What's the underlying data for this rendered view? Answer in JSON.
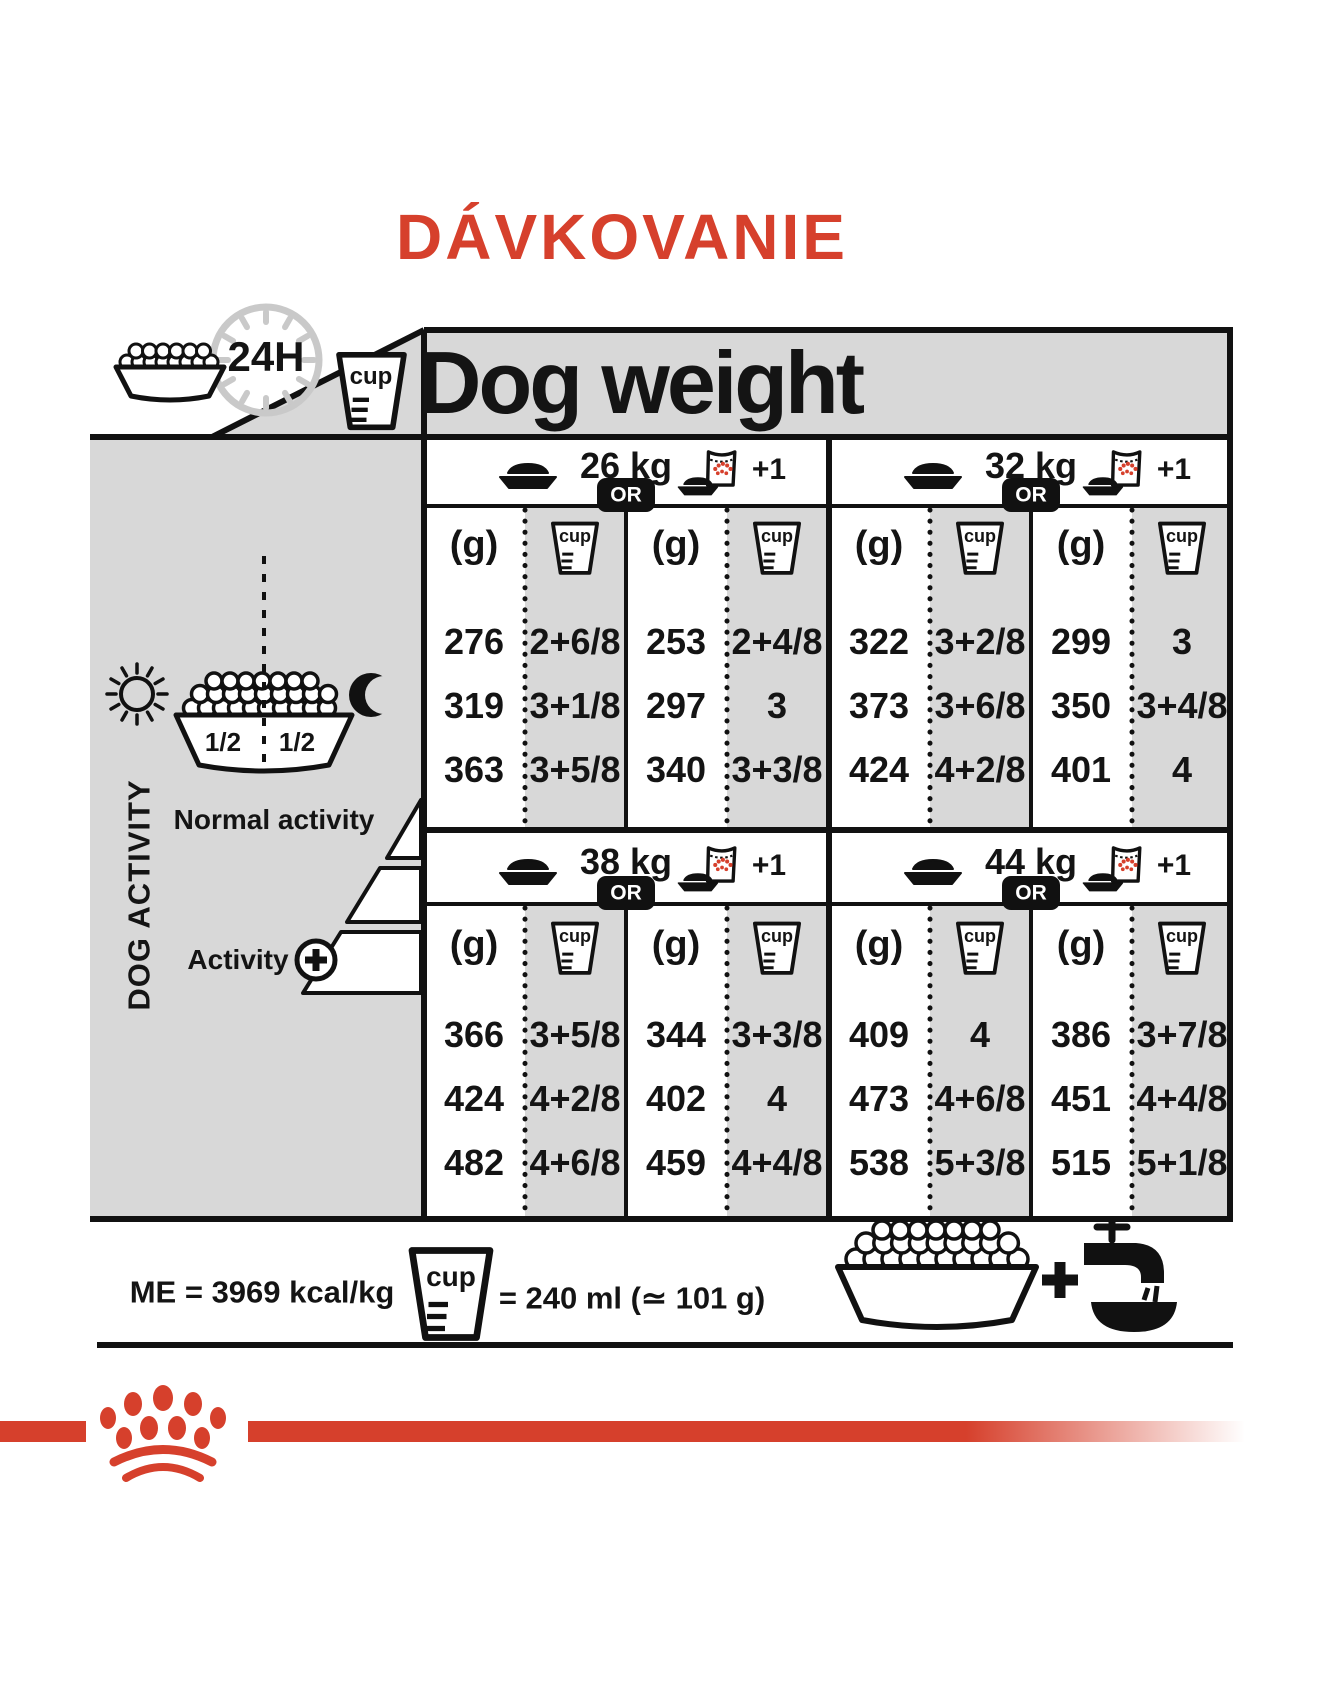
{
  "title": "DÁVKOVANIE",
  "colors": {
    "red": "#d6402c",
    "panel_gray": "#d8d8d8"
  },
  "header": {
    "daily_ration": "24H",
    "dog_weight": "Dog weight"
  },
  "units": {
    "grams": "(g)",
    "cup": "cup",
    "or": "OR",
    "plus_one": "+1"
  },
  "sidebar": {
    "dog_activity": "DOG ACTIVITY",
    "half_left": "1/2",
    "half_right": "1/2",
    "normal_activity": "Normal activity",
    "activity_plus": "Activity"
  },
  "sections": [
    {
      "weight": "26 kg",
      "rows": [
        [
          "276",
          "2+6/8",
          "253",
          "2+4/8"
        ],
        [
          "319",
          "3+1/8",
          "297",
          "3"
        ],
        [
          "363",
          "3+5/8",
          "340",
          "3+3/8"
        ]
      ]
    },
    {
      "weight": "32 kg",
      "rows": [
        [
          "322",
          "3+2/8",
          "299",
          "3"
        ],
        [
          "373",
          "3+6/8",
          "350",
          "3+4/8"
        ],
        [
          "424",
          "4+2/8",
          "401",
          "4"
        ]
      ]
    },
    {
      "weight": "38 kg",
      "rows": [
        [
          "366",
          "3+5/8",
          "344",
          "3+3/8"
        ],
        [
          "424",
          "4+2/8",
          "402",
          "4"
        ],
        [
          "482",
          "4+6/8",
          "459",
          "4+4/8"
        ]
      ]
    },
    {
      "weight": "44 kg",
      "rows": [
        [
          "409",
          "4",
          "386",
          "3+7/8"
        ],
        [
          "473",
          "4+6/8",
          "451",
          "4+4/8"
        ],
        [
          "538",
          "5+3/8",
          "515",
          "5+1/8"
        ]
      ]
    }
  ],
  "footer": {
    "energy": "ME = 3969 kcal/kg",
    "cup_equivalence": "= 240 ml (≃ 101 g)"
  }
}
